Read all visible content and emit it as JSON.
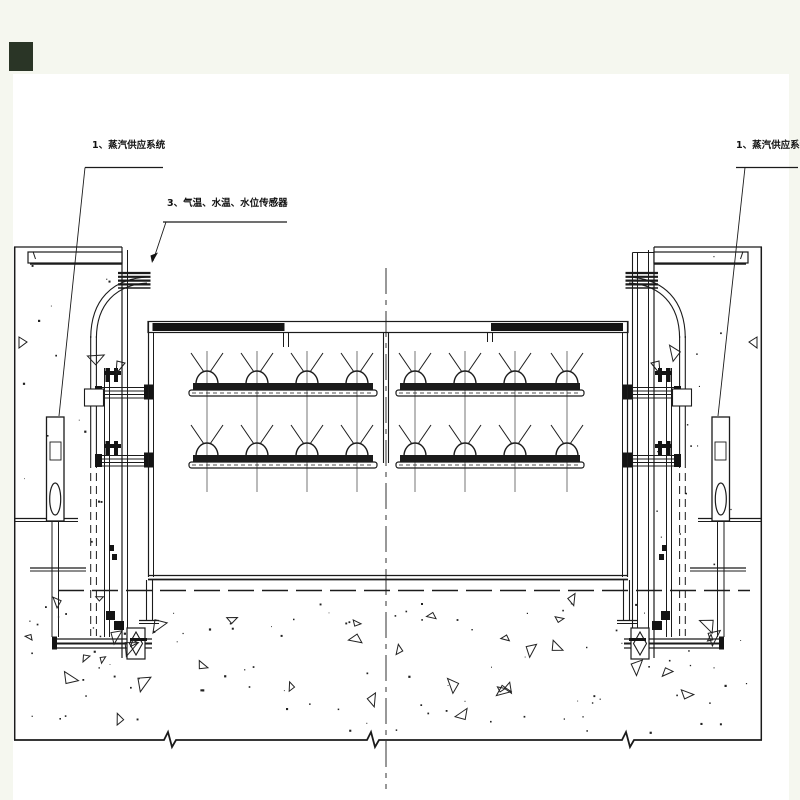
{
  "page": {
    "margin_color": "#f5f7ef",
    "paper_color": "#ffffff"
  },
  "corner_marker": {
    "color": "#2a3526"
  },
  "drawing": {
    "line_color": "#1b1b1b",
    "annotations": {
      "left_steam_label": "1、蒸汽供应系统",
      "sensor_label": "3、气温、水温、水位传感器",
      "right_steam_label": "1、蒸汽供应系统"
    }
  }
}
